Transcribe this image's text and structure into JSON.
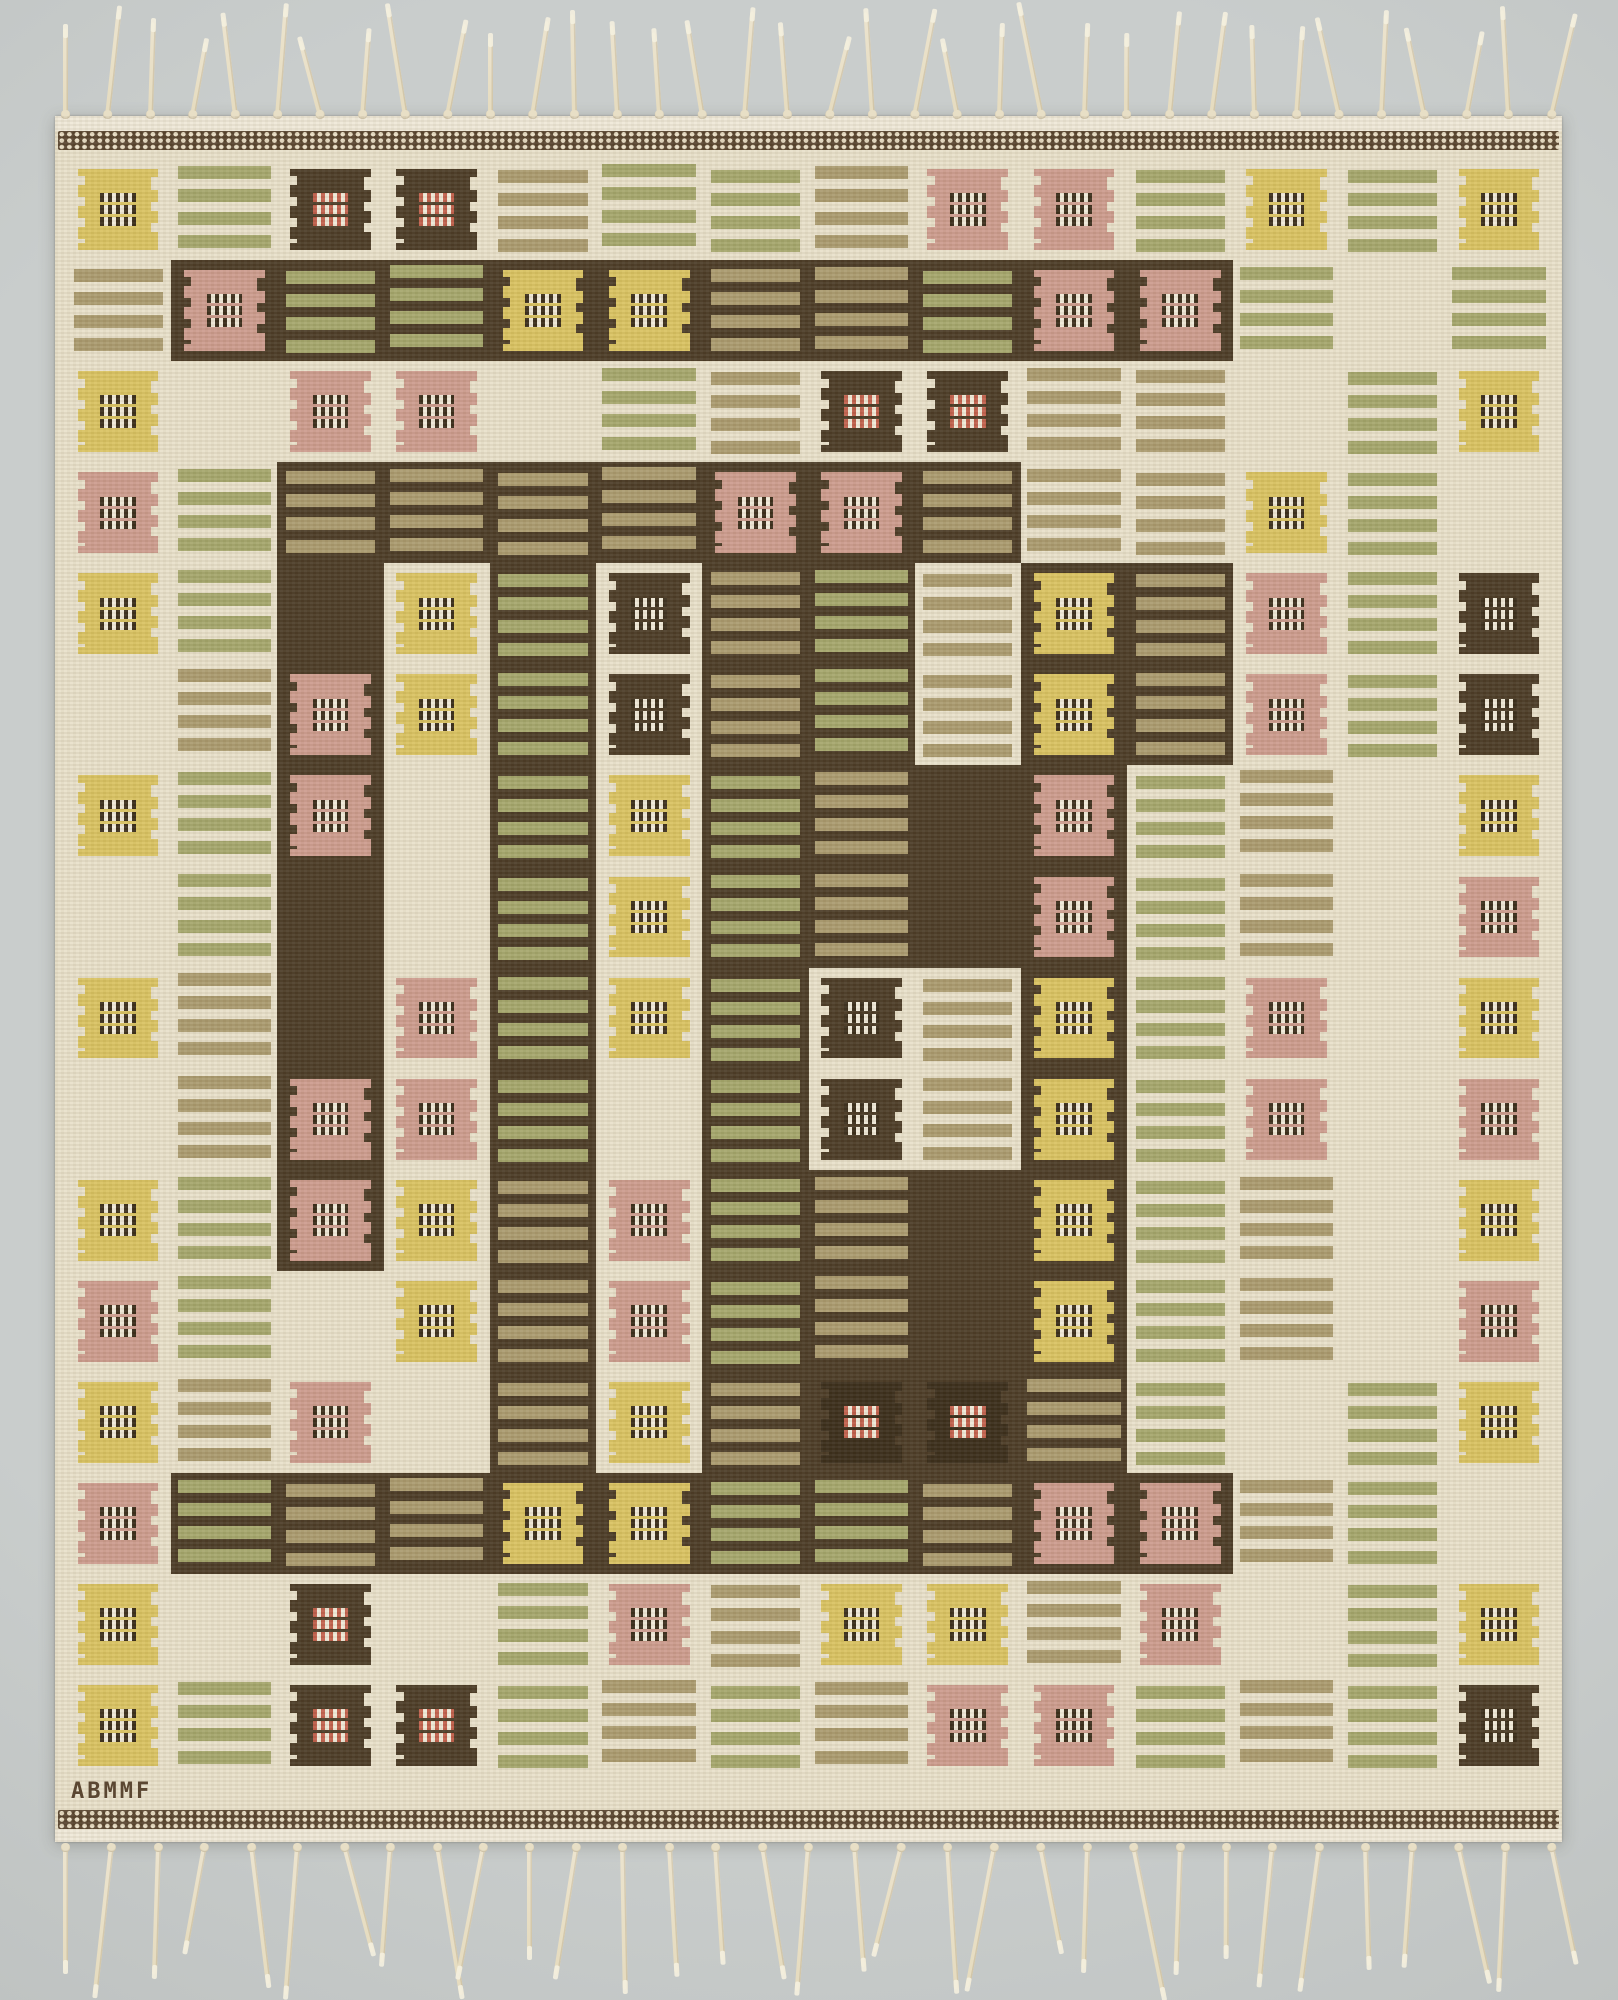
{
  "scene": {
    "background_color": "#c5c9c8",
    "vignette_color": "#b0b4b3"
  },
  "rug": {
    "signature": "ABMMF",
    "palette": {
      "cream": "#e9e1ca",
      "cream_light": "#efe9d8",
      "paper": "#f0ead8",
      "dark": "#4b3b26",
      "dark_deep": "#392c1a",
      "green": "#a5a76c",
      "tan": "#ab9b6f",
      "yellow": "#dac361",
      "pink": "#cd9c8e",
      "red": "#c2604c",
      "band_brown": "#57432d"
    },
    "border_band": {
      "base_color": "#57432d",
      "dot_color": "#eadfc6"
    },
    "fringe": {
      "color": "#ece4cf",
      "top_count": 36,
      "top_length": 88,
      "bottom_count": 33,
      "bottom_length": 124
    },
    "grid": {
      "columns": 14,
      "rows": 16,
      "legend": {
        "Y": {
          "kind": "motif",
          "bg": "cream",
          "square": "yellow",
          "dash": "dark_deep"
        },
        "P": {
          "kind": "motif",
          "bg": "cream",
          "square": "pink",
          "dash": "dark_deep"
        },
        "R": {
          "kind": "motif",
          "bg": "cream",
          "square": "dark",
          "dash": "red"
        },
        "K": {
          "kind": "motif",
          "bg": "cream",
          "square": "dark",
          "dash": "dark_deep"
        },
        "y": {
          "kind": "motif",
          "bg": "dark",
          "square": "yellow",
          "dash": "dark_deep"
        },
        "p": {
          "kind": "motif",
          "bg": "dark",
          "square": "pink",
          "dash": "dark_deep"
        },
        "r": {
          "kind": "motif",
          "bg": "dark",
          "square": "dark_deep",
          "dash": "red"
        },
        "G": {
          "kind": "stripes",
          "bg": "cream",
          "stripe": "green"
        },
        "T": {
          "kind": "stripes",
          "bg": "cream",
          "stripe": "tan"
        },
        "g": {
          "kind": "stripes",
          "bg": "dark",
          "stripe": "green"
        },
        "t": {
          "kind": "stripes",
          "bg": "dark",
          "stripe": "tan"
        },
        "D": {
          "kind": "plain",
          "bg": "dark"
        },
        "C": {
          "kind": "plain",
          "bg": "cream"
        }
      },
      "cells": [
        "Y G R R T G G T P P G Y G Y",
        "T p g g y y t t g p p G C G",
        "Y C P P C G T R R T T C G Y",
        "P G t t t t p p t T T Y G C",
        "Y G D Y g K t g T y t P G K",
        "C T p Y g K t g T y t P G K",
        "Y G p C g Y g t D p G T C Y",
        "C G D C g Y g t D p G T C P",
        "Y T D P g Y g K T y G P C Y",
        "C T p P g C g K T y G P C P",
        "Y G p Y t P g t D y G T C Y",
        "P G C Y t P g t D y G T C P",
        "Y T P C t Y t r r t G C G Y",
        "P g t t y y g g t p p T G C",
        "Y C R C G P T Y Y T P C G Y",
        "Y G R R G T G T P P G T G K"
      ]
    }
  }
}
